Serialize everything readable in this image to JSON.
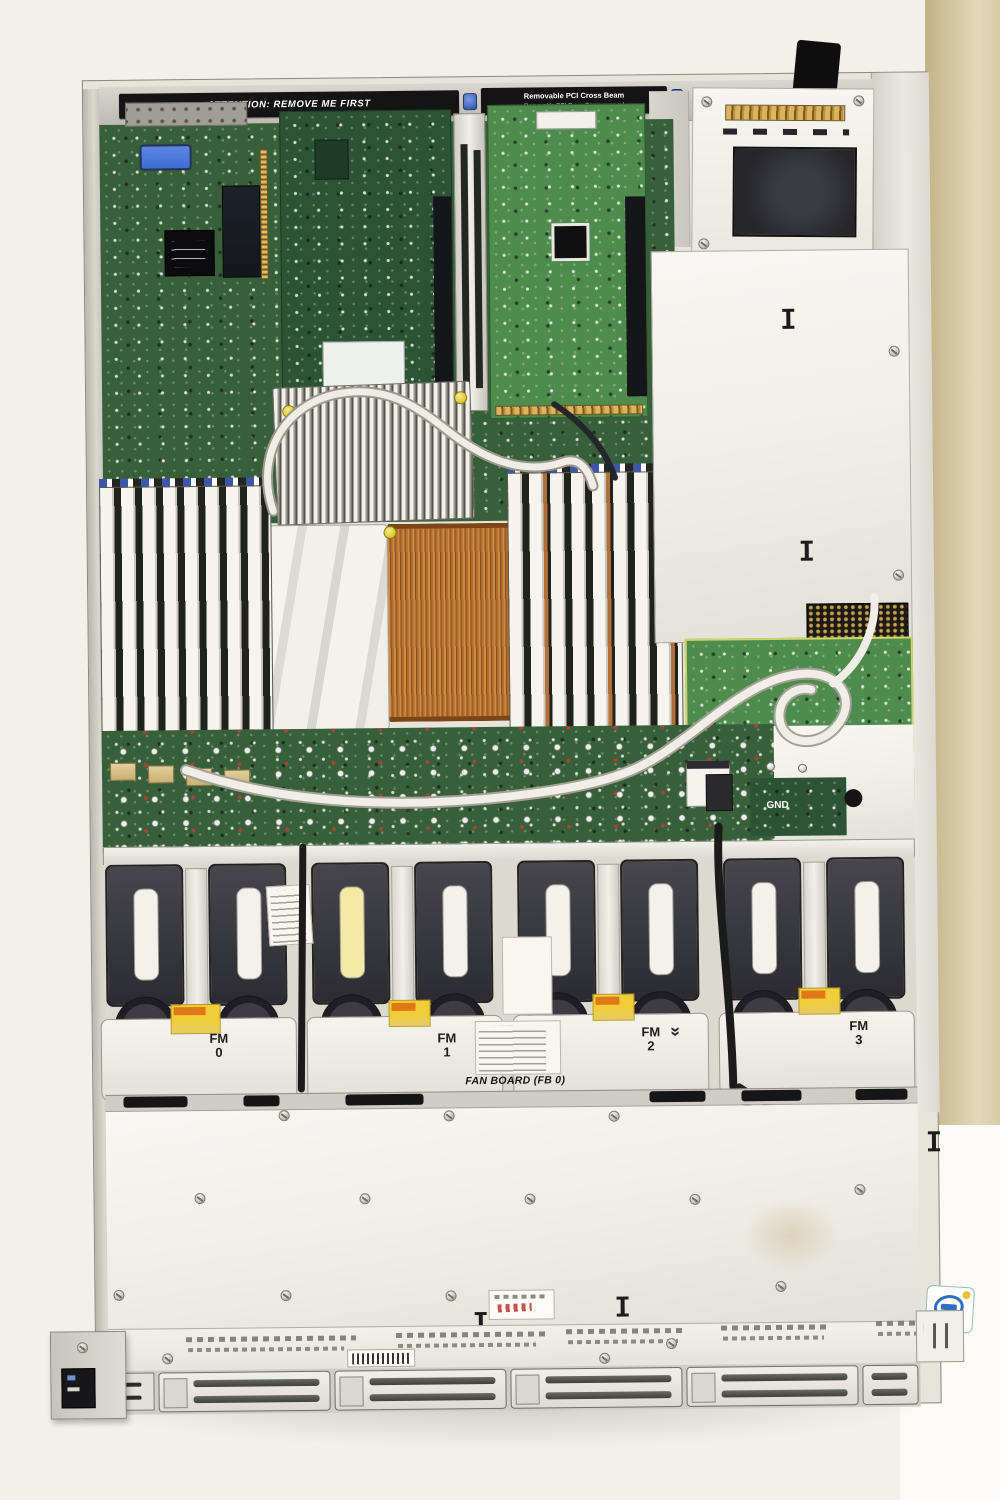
{
  "scene": {
    "title": "Open 1U rack server chassis, top view photograph"
  },
  "warning_rail": {
    "left_arrow_icon": "←",
    "attention_label": "ATTENTION:  REMOVE ME FIRST",
    "beam_label": "Removable PCI Cross Beam",
    "beam_removal_label": "Removable PCI Cross Beam removal",
    "right_arrow_icon": "→"
  },
  "fan_section": {
    "modules": [
      {
        "line1": "FM",
        "line2": "0"
      },
      {
        "line1": "FM",
        "line2": "1"
      },
      {
        "line1": "FM",
        "line2": "2"
      },
      {
        "line1": "FM",
        "line2": "3"
      }
    ],
    "board_label": "FAN BOARD (FB 0)",
    "chevron_icon": "»"
  },
  "pcb_labels": {
    "gnd_label": "GND"
  },
  "colors": {
    "pcb_green": "#375f39",
    "pcb_dark": "#2c5434",
    "pcb_bright": "#4e8c4e",
    "copper": "#b06a2c",
    "dimm_white": "#f5f4ef",
    "warning_yellow": "#f0cd39",
    "warning_orange": "#e07818",
    "tan_bg": "#cdbb92",
    "blue_screw": "#4a6fc8",
    "psu_dark": "#26262b",
    "intel_blue": "#2e6fc0",
    "cable_white": "#efede5"
  }
}
